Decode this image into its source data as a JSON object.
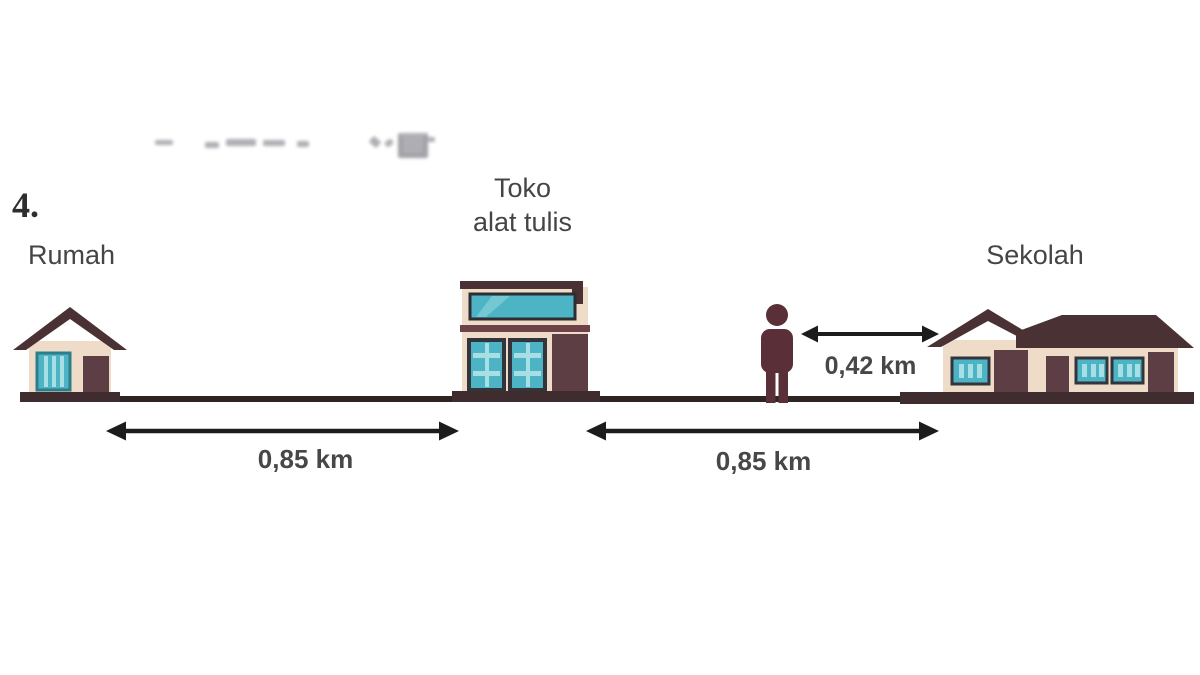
{
  "question_number": "4.",
  "labels": {
    "house": "Rumah",
    "store_line1": "Toko",
    "store_line2": "alat tulis",
    "school": "Sekolah"
  },
  "distances": {
    "house_to_store": "0,85 km",
    "store_to_school": "0,85 km",
    "person_to_school": "0,42 km"
  },
  "colors": {
    "roof": "#4a3134",
    "door": "#5d3e44",
    "wall": "#efdcc8",
    "teal": "#4cb4c4",
    "teal-dark": "#2e7d8a",
    "teal-light": "#a7dfe4",
    "stripe": "#6d4348",
    "base": "#3e2c2e",
    "ground": "#2e2523",
    "arrow": "#1c1c1c",
    "person": "#5b2f37",
    "text": "#454545",
    "number": "#2e2e2e"
  }
}
